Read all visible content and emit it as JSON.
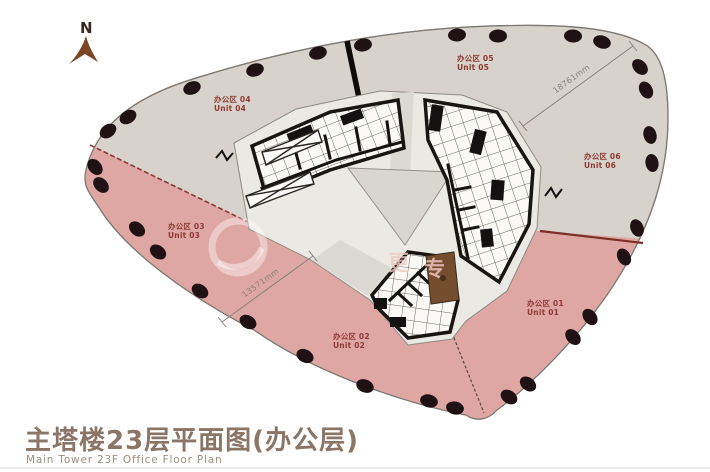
{
  "title": {
    "cn": "主塔楼23层平面图(办公层)",
    "en": "Main Tower 23F Office Floor Plan"
  },
  "compass": {
    "label": "N"
  },
  "units": [
    {
      "id": "01",
      "cn": "办公区 01",
      "en": "Unit 01",
      "zone": "pink"
    },
    {
      "id": "02",
      "cn": "办公区 02",
      "en": "Unit 02",
      "zone": "pink"
    },
    {
      "id": "03",
      "cn": "办公区 03",
      "en": "Unit 03",
      "zone": "pink"
    },
    {
      "id": "04",
      "cn": "办公区 04",
      "en": "Unit 04",
      "zone": "gray"
    },
    {
      "id": "05",
      "cn": "办公区 05",
      "en": "Unit 05",
      "zone": "gray"
    },
    {
      "id": "06",
      "cn": "办公区 06",
      "en": "Unit 06",
      "zone": "gray"
    }
  ],
  "dimensions": [
    {
      "label": "18761mm"
    },
    {
      "label": "13571mm"
    }
  ],
  "watermark": {
    "char1": "更",
    "char2": "专"
  },
  "colors": {
    "gray_zone": "#d7d2cc",
    "pink_zone": "#dfa7a4",
    "boundary_red": "#7c2f28",
    "label_red": "#8e3a33",
    "column_dot": "#1f1114",
    "core_wall": "#181512",
    "highlight_room": "#744e2f",
    "title_brown": "#8b7566",
    "compass_brown": "#7d4426"
  }
}
